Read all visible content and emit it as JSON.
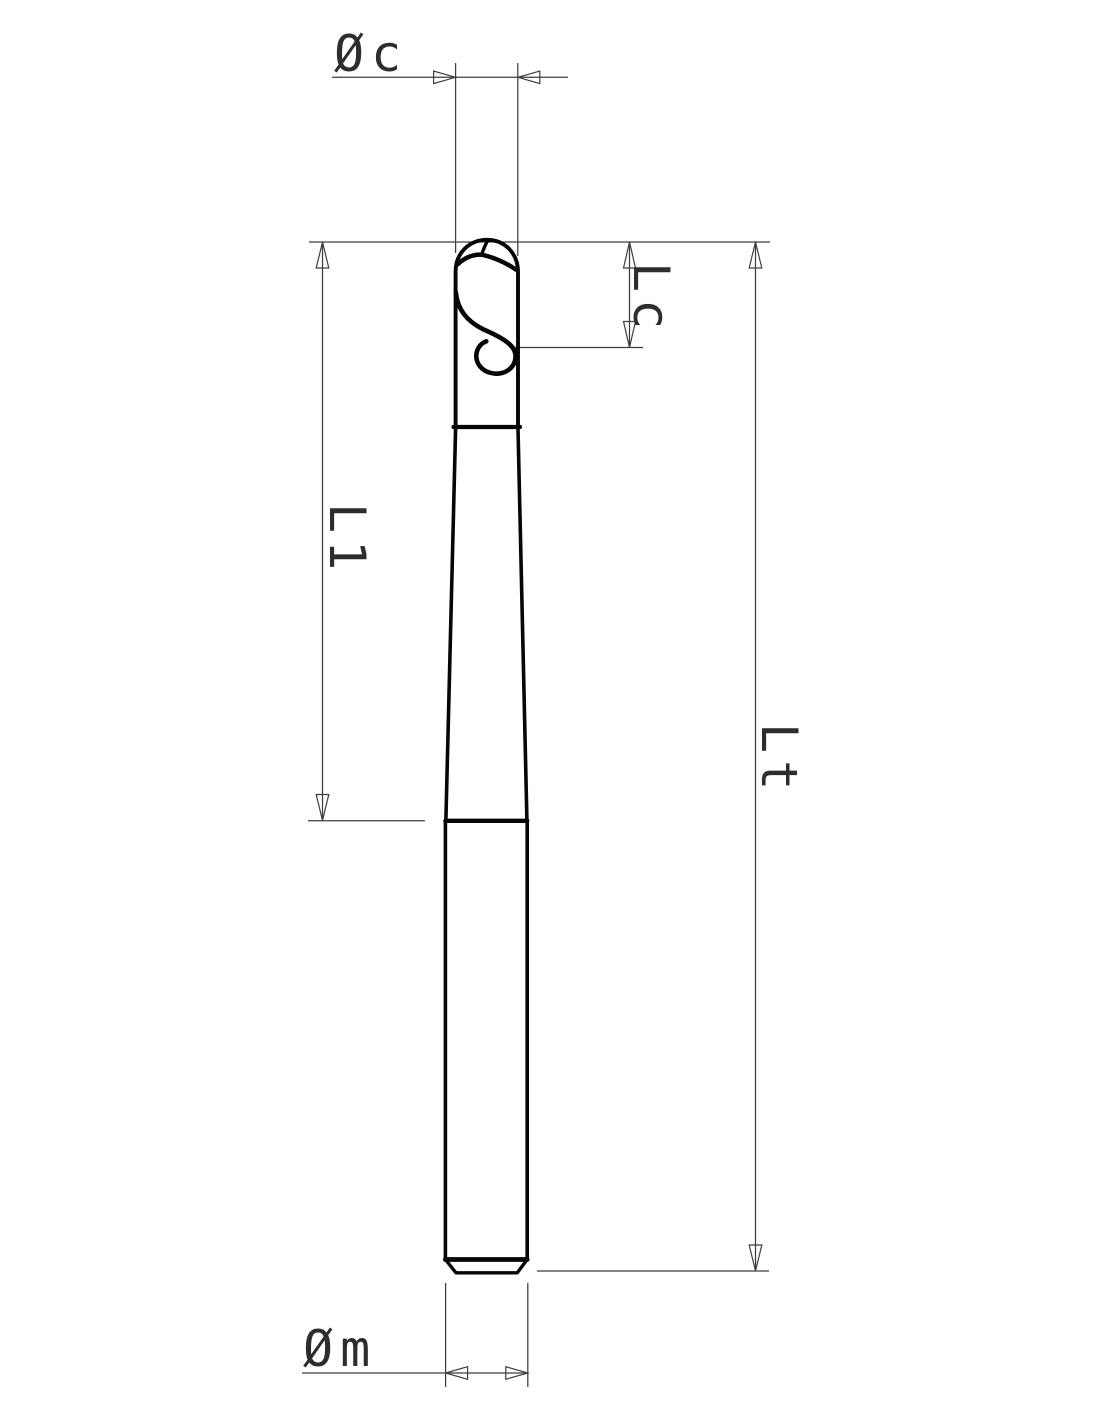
{
  "drawing": {
    "kind": "technical dimension drawing",
    "subject": "two-flute ball nose end mill, side view",
    "background": "#ffffff"
  },
  "labels": {
    "cutting_diameter": "Øc",
    "cutting_length": "Lc",
    "neck_length": "L1",
    "overall_length": "Lt",
    "shank_diameter": "Øm"
  },
  "colors": {
    "dimension_line": "#3e3e3e",
    "tool_outline": "#060606",
    "label_text": "#2d2d2d"
  }
}
